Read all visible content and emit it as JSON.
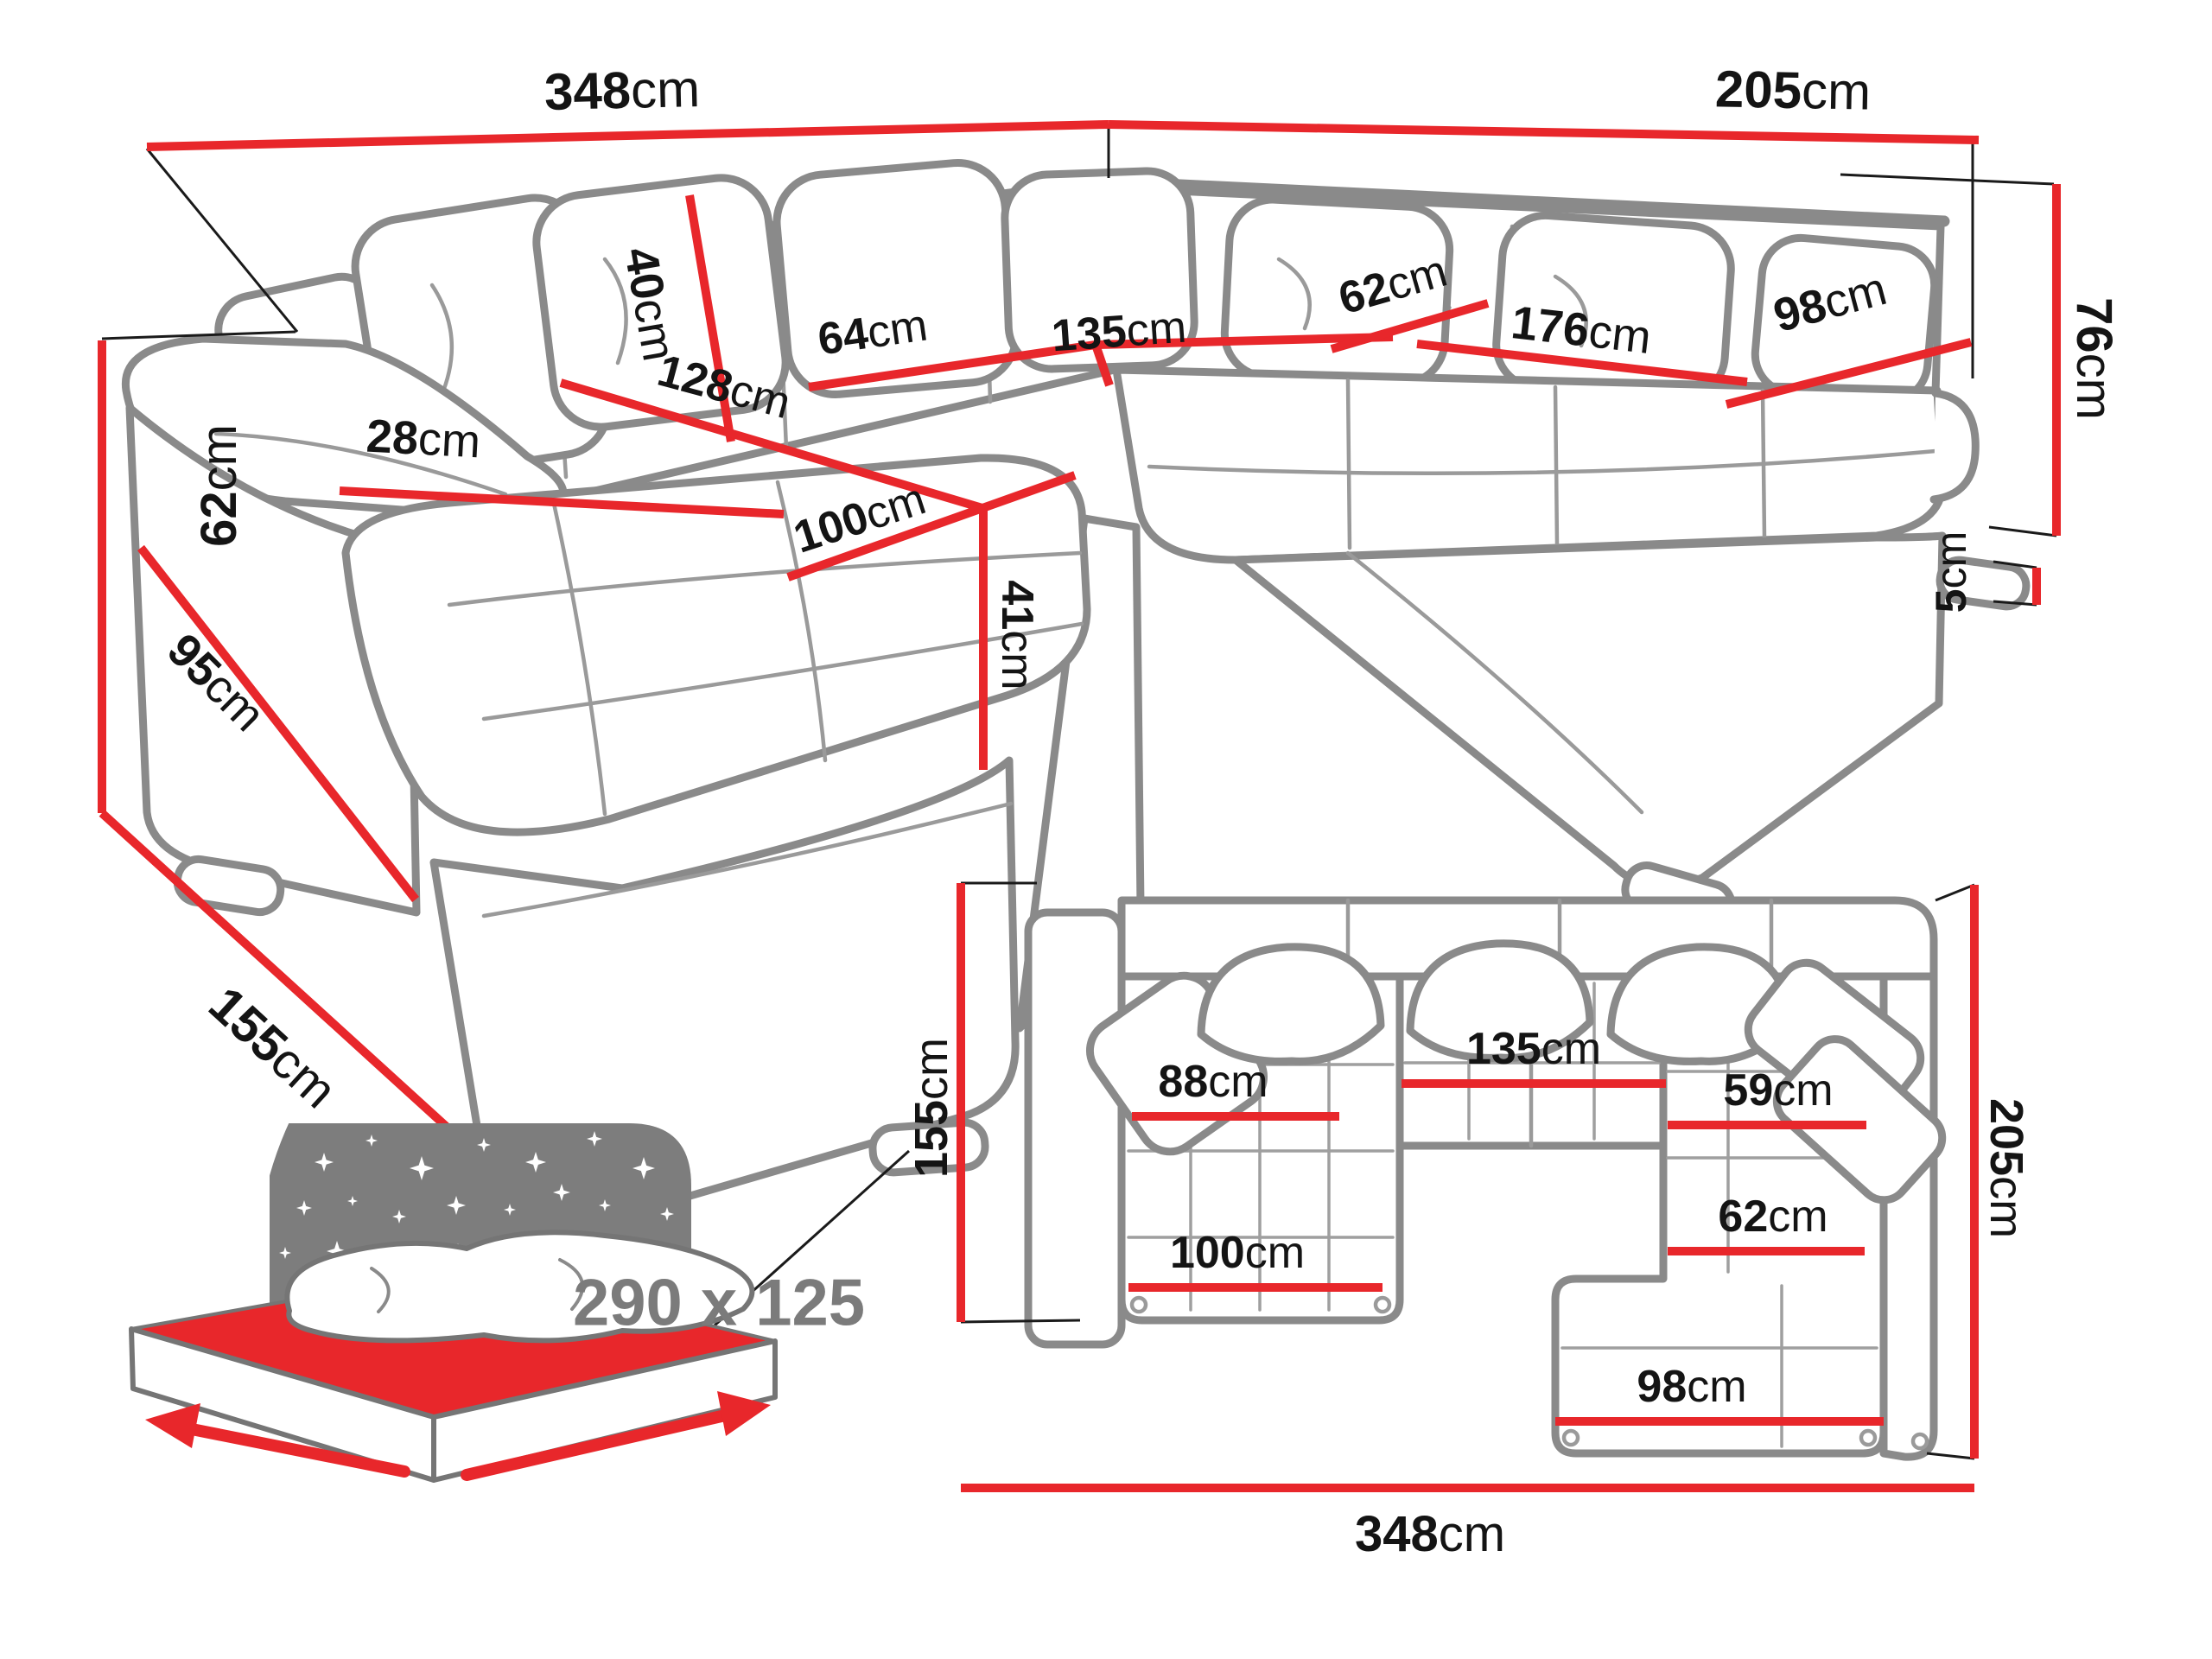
{
  "colors": {
    "dimension_red": "#e8272b",
    "outline_grey": "#8a8a8a",
    "icon_grey": "#7b7b7b",
    "label_black": "#141414"
  },
  "persp": {
    "d348": {
      "v": "348",
      "u": "cm"
    },
    "d205": {
      "v": "205",
      "u": "cm"
    },
    "d76": {
      "v": "76",
      "u": "cm"
    },
    "d62": {
      "v": "62",
      "u": "cm"
    },
    "d155": {
      "v": "155",
      "u": "cm"
    },
    "d95": {
      "v": "95",
      "u": "cm"
    },
    "d28": {
      "v": "28",
      "u": "cm"
    },
    "d40": {
      "v": "40",
      "u": "cm"
    },
    "d64": {
      "v": "64",
      "u": "cm"
    },
    "d135": {
      "v": "135",
      "u": "cm"
    },
    "d128": {
      "v": "128",
      "u": "cm"
    },
    "d100": {
      "v": "100",
      "u": "cm"
    },
    "d41": {
      "v": "41",
      "u": "cm"
    },
    "d62b": {
      "v": "62",
      "u": "cm"
    },
    "d176": {
      "v": "176",
      "u": "cm"
    },
    "d98": {
      "v": "98",
      "u": "cm"
    },
    "d5": {
      "v": "5",
      "u": "cm"
    }
  },
  "sleep": {
    "size": "290 x 125"
  },
  "plan": {
    "d155": {
      "v": "155",
      "u": "cm"
    },
    "d205": {
      "v": "205",
      "u": "cm"
    },
    "d348": {
      "v": "348",
      "u": "cm"
    },
    "d88": {
      "v": "88",
      "u": "cm"
    },
    "d135": {
      "v": "135",
      "u": "cm"
    },
    "d59": {
      "v": "59",
      "u": "cm"
    },
    "d100": {
      "v": "100",
      "u": "cm"
    },
    "d62": {
      "v": "62",
      "u": "cm"
    },
    "d98": {
      "v": "98",
      "u": "cm"
    }
  }
}
